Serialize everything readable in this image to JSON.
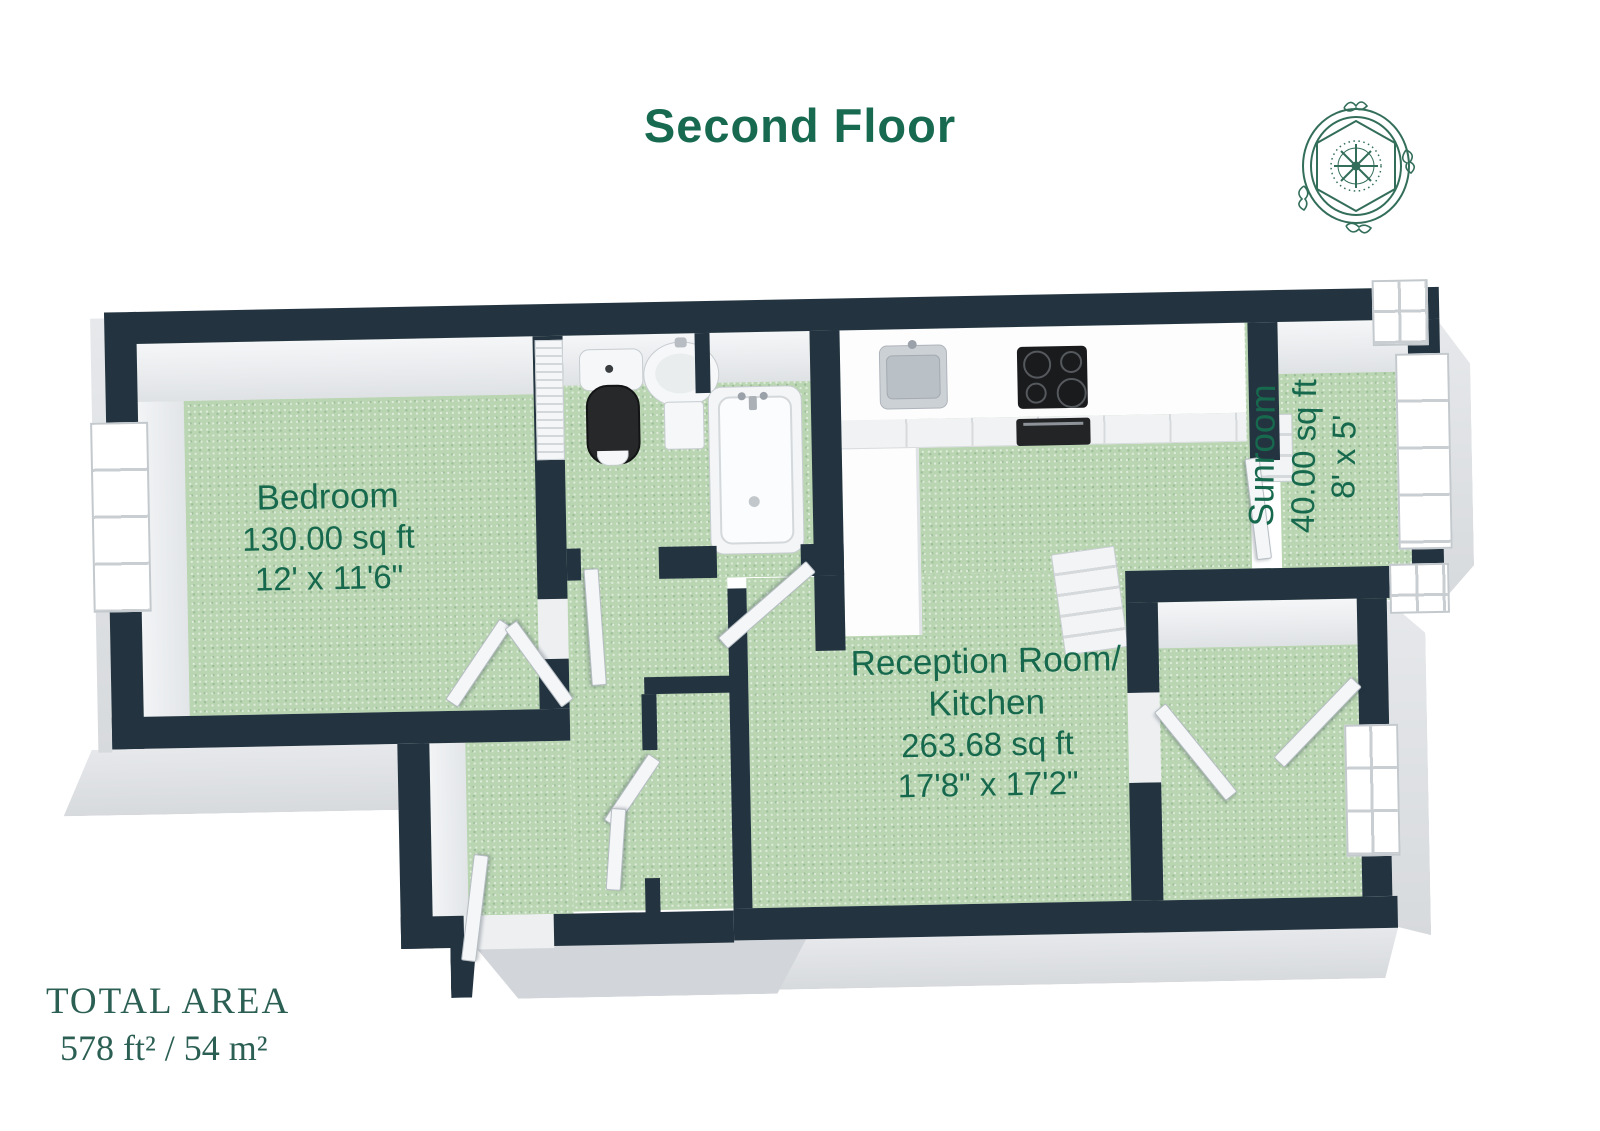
{
  "title": "Second Floor",
  "rooms": [
    {
      "name": "Bedroom",
      "area": "130.00 sq ft",
      "dimensions": "12' x 11'6\""
    },
    {
      "name_line1": "Reception Room/",
      "name_line2": "Kitchen",
      "area": "263.68 sq ft",
      "dimensions": "17'8\" x 17'2\""
    },
    {
      "name": "Sunroom",
      "area": "40.00 sq ft",
      "dimensions": "8' x 5'"
    }
  ],
  "total_area": {
    "label": "TOTAL AREA",
    "value": "578 ft² / 54 m²"
  },
  "fixtures": [
    "toilet",
    "pedestal-sink",
    "bathtub",
    "kitchen-sink",
    "cooktop",
    "oven",
    "kitchen-counter",
    "radiator",
    "towel-radiator",
    "wardrobe-louver",
    "bedroom-window",
    "sunroom-windows",
    "reception-window",
    "compass-logo"
  ],
  "colors": {
    "wall": "#233440",
    "floor": "#b9d5b1",
    "label_text": "#17694e",
    "title_text": "#176a50",
    "total_text": "#2c5f53",
    "landing": "#d2d5d9"
  }
}
